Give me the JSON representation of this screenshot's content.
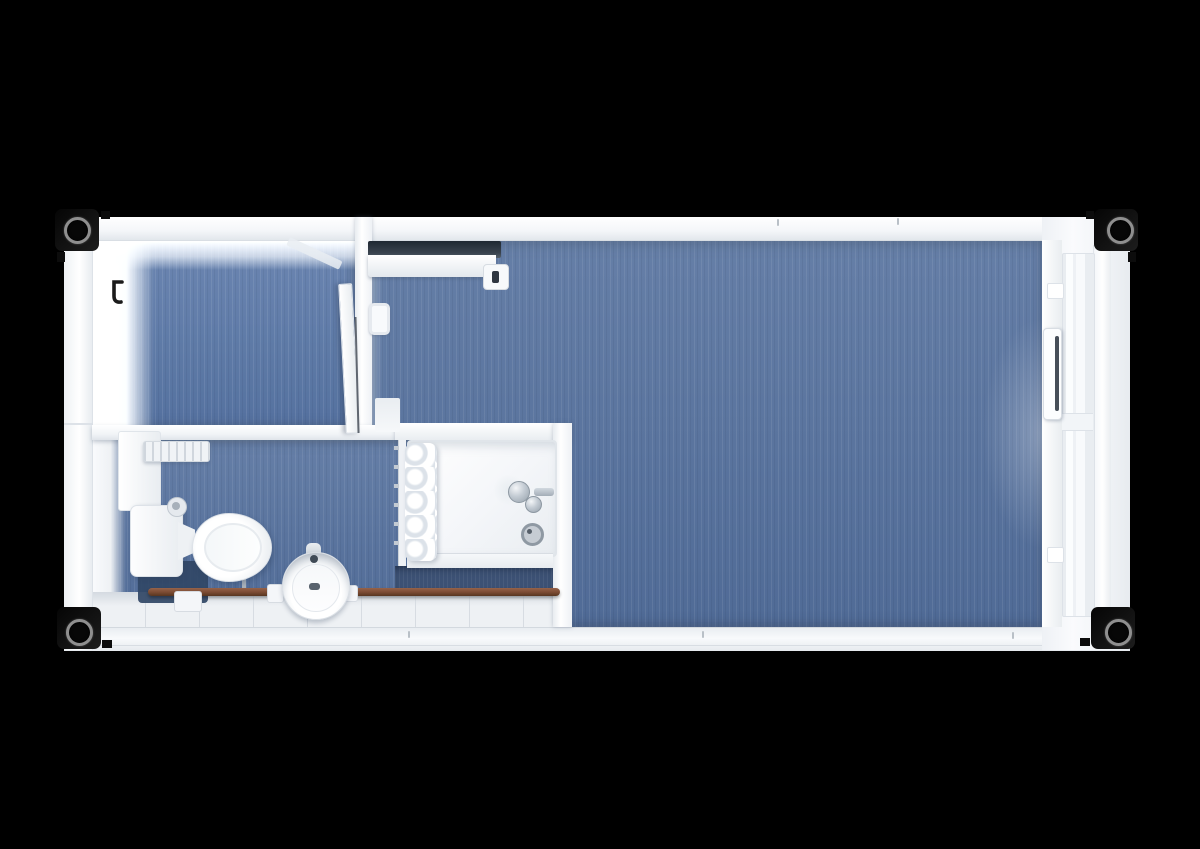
{
  "scene": {
    "title": "container-cabin-floor-plan-top-view",
    "background_color": "#000000",
    "render_style": "3d-top-down-render",
    "rooms": [
      {
        "name": "small-office-room",
        "position": "top-left",
        "floor_color": "#5d79a7"
      },
      {
        "name": "main-room",
        "position": "right",
        "floor_color": "#54709d"
      },
      {
        "name": "bathroom",
        "position": "bottom-left",
        "floor_color": "#54709d",
        "tile_color": "#eef1f4",
        "shadow_floor_color": "#3c5174"
      }
    ],
    "fixtures": [
      "corner-casting-top-left",
      "corner-casting-top-right",
      "corner-casting-bottom-left",
      "corner-casting-bottom-right",
      "entry-door-right-end",
      "interior-door-ajar",
      "coat-hook",
      "wall-heater",
      "wall-shelf",
      "ribbed-radiator",
      "toilet-cistern",
      "toilet-bowl",
      "flush-knob",
      "pedestal-sink",
      "shower-cabin",
      "shower-curtain",
      "curtain-rail",
      "shower-mixer",
      "shower-drain",
      "heating-pipe",
      "pipe-clips",
      "service-duct"
    ],
    "colors": {
      "wall_white": "#f4f6f8",
      "wall_shadow": "#d8dde3",
      "floor_blue": "#54709d",
      "floor_blue_light": "#5d79a7",
      "floor_blue_dark": "#3c5174",
      "tile_white": "#eef1f4",
      "pipe_copper": "#7a4a32",
      "chrome": "#aab3bc",
      "casting_black": "#101010",
      "heater_dark": "#2b3540"
    }
  }
}
